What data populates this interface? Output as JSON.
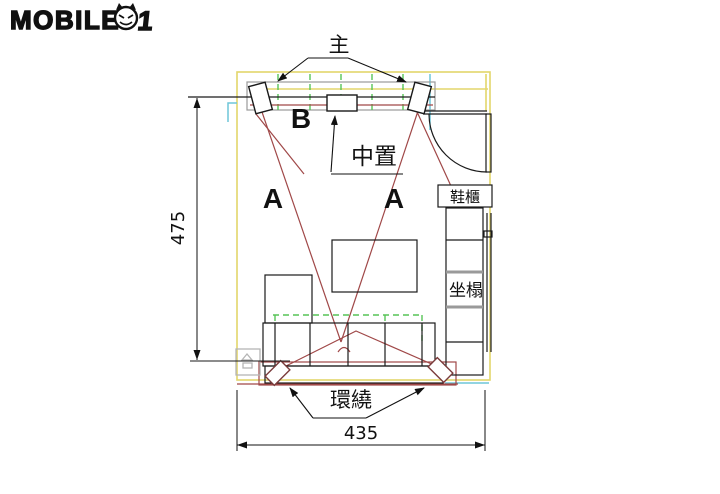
{
  "logo": {
    "part1": "MOBILE",
    "part2": "1",
    "full_name": "MOBILE01"
  },
  "labels": {
    "main_speakers": "主",
    "b_position": "B",
    "center_speaker": "中置",
    "a_left": "A",
    "a_right": "A",
    "shoe_cabinet": "鞋櫃",
    "bench_seat": "坐榻",
    "surround_speakers": "環繞"
  },
  "dimensions": {
    "room_depth": "475",
    "room_width": "435"
  },
  "colors": {
    "wall_yellow": "#e3d66b",
    "accent_cyan": "#6ec6d8",
    "aim_red": "#a04848",
    "dashed_green": "#57c457",
    "line_black": "#1a1a1a",
    "gray": "#9a9a9a"
  }
}
